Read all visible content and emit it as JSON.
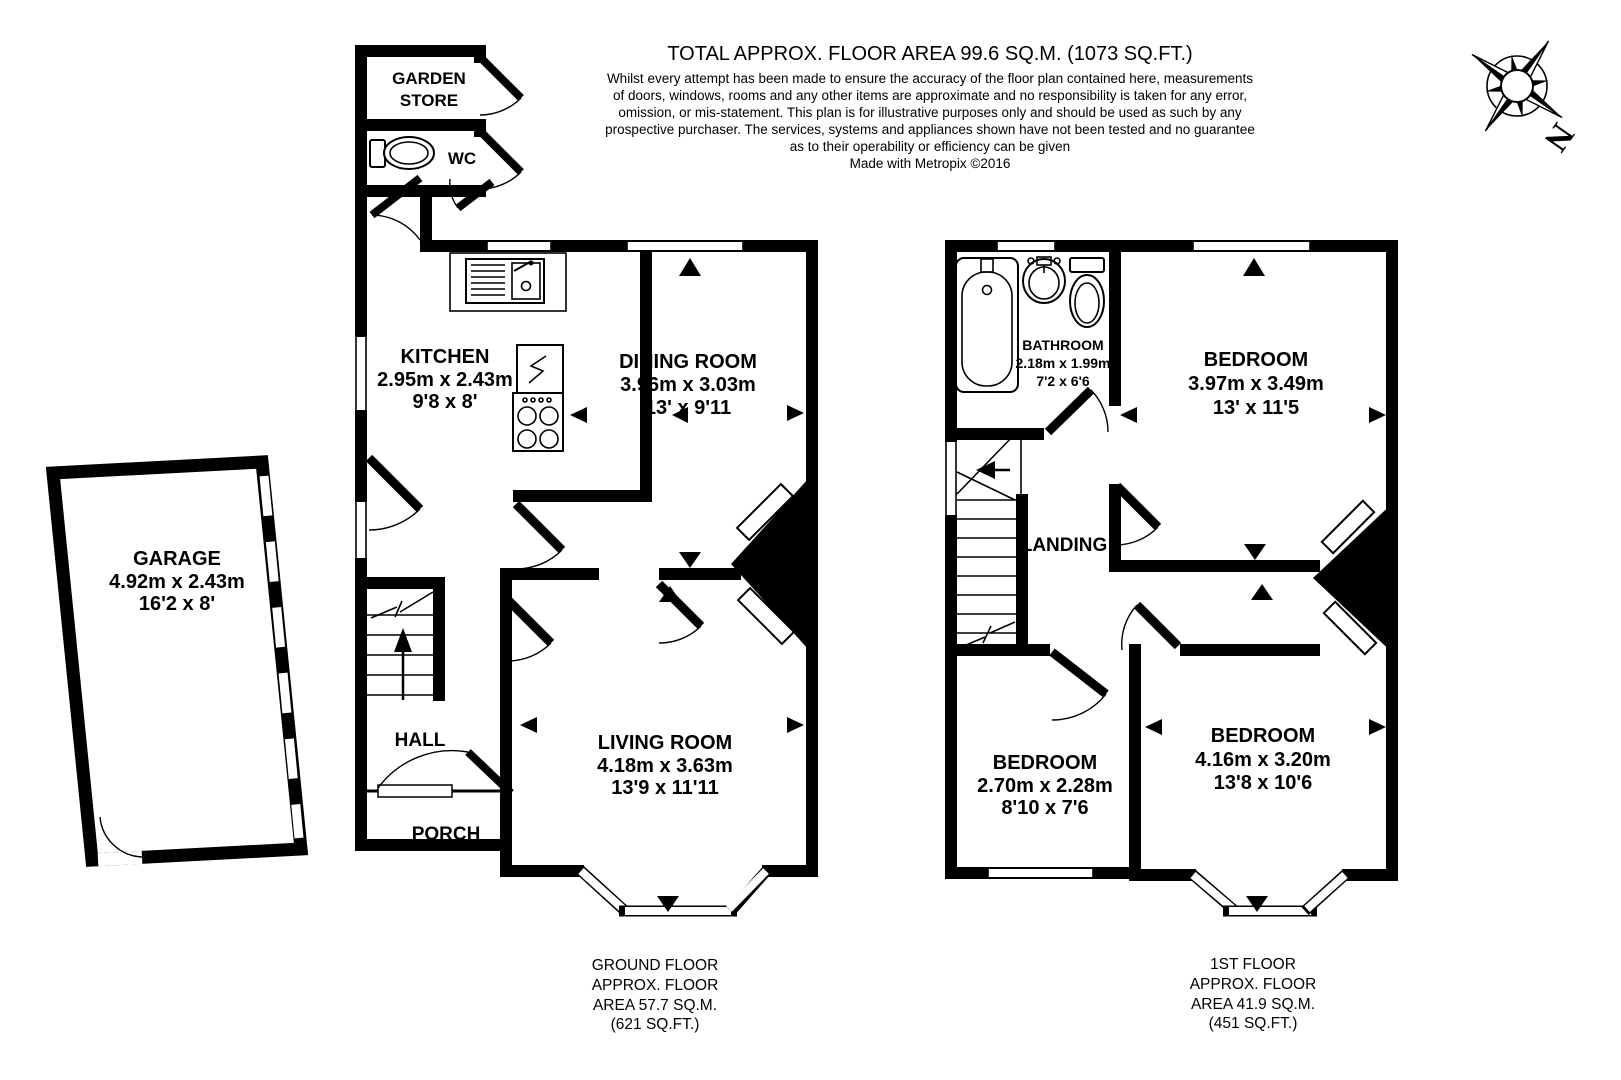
{
  "header": {
    "title": "TOTAL APPROX. FLOOR AREA 99.6 SQ.M. (1073 SQ.FT.)",
    "disclaimer": [
      "Whilst every attempt has been made to ensure the accuracy of the floor plan contained here, measurements",
      "of doors, windows, rooms and any other items are approximate and no responsibility is taken for any error,",
      "omission, or mis-statement. This plan is for illustrative purposes only and should be used as such by any",
      "prospective purchaser. The services, systems and appliances shown have not been tested and no guarantee",
      "as to their operability or efficiency can be given"
    ],
    "credit": "Made with Metropix ©2016"
  },
  "compass": {
    "north_label": "N"
  },
  "ground_floor": {
    "rooms": {
      "garden_store": {
        "name_lines": [
          "GARDEN",
          "STORE"
        ]
      },
      "wc": {
        "name": "WC"
      },
      "kitchen": {
        "name": "KITCHEN",
        "metric": "2.95m x 2.43m",
        "imperial": "9'8 x 8'"
      },
      "dining_room": {
        "name": "DINING ROOM",
        "metric": "3.96m x 3.03m",
        "imperial": "13' x 9'11"
      },
      "living_room": {
        "name": "LIVING ROOM",
        "metric": "4.18m x 3.63m",
        "imperial": "13'9 x 11'11"
      },
      "hall": {
        "name": "HALL"
      },
      "porch": {
        "name": "PORCH"
      },
      "garage": {
        "name": "GARAGE",
        "metric": "4.92m x 2.43m",
        "imperial": "16'2 x 8'"
      }
    },
    "footer_lines": [
      "GROUND FLOOR",
      "APPROX. FLOOR",
      "AREA 57.7 SQ.M.",
      "(621 SQ.FT.)"
    ]
  },
  "first_floor": {
    "rooms": {
      "bathroom": {
        "name": "BATHROOM",
        "metric": "2.18m x 1.99m",
        "imperial": "7'2 x 6'6"
      },
      "bedroom_main": {
        "name": "BEDROOM",
        "metric": "3.97m x 3.49m",
        "imperial": "13' x 11'5"
      },
      "landing": {
        "name": "LANDING"
      },
      "bedroom_small": {
        "name": "BEDROOM",
        "metric": "2.70m x 2.28m",
        "imperial": "8'10 x 7'6"
      },
      "bedroom_rear": {
        "name": "BEDROOM",
        "metric": "4.16m x 3.20m",
        "imperial": "13'8 x 10'6"
      }
    },
    "footer_lines": [
      "1ST FLOOR",
      "APPROX. FLOOR",
      "AREA 41.9 SQ.M.",
      "(451 SQ.FT.)"
    ]
  },
  "colors": {
    "wall": "#000000",
    "background": "#ffffff"
  }
}
